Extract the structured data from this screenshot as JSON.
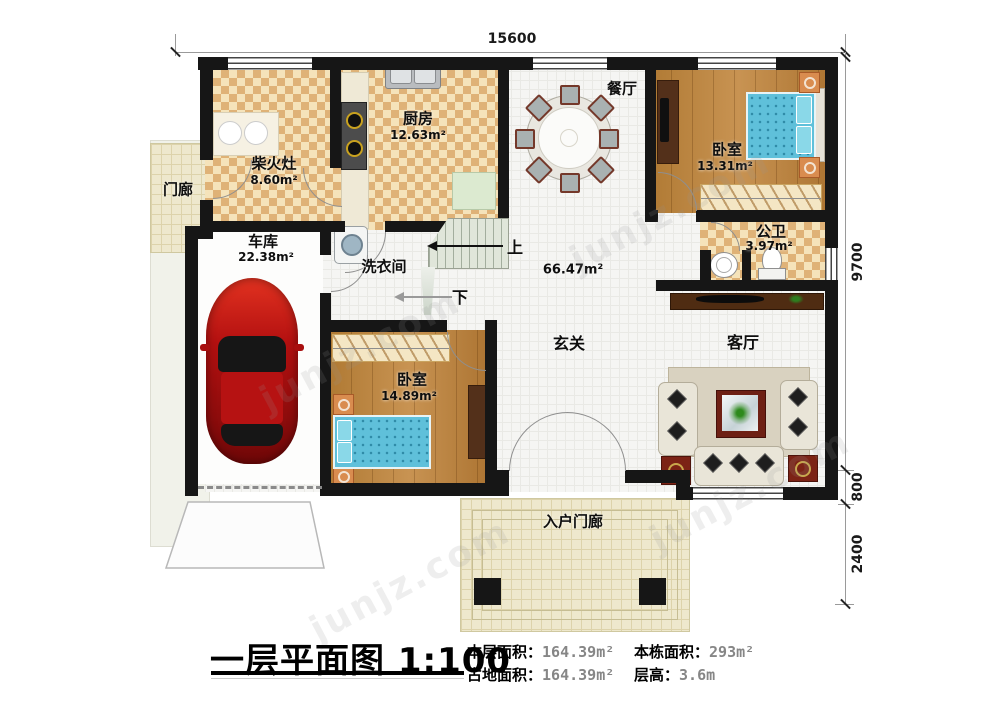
{
  "watermark": {
    "text": "junjz.com"
  },
  "dimensions": {
    "width": "15600",
    "depth": "9700",
    "porch_depth": "800",
    "entry_depth": "2400"
  },
  "rooms": {
    "firewood": {
      "label": "柴火灶",
      "area": "8.60m²"
    },
    "kitchen": {
      "label": "厨房",
      "area": "12.63m²"
    },
    "dining": {
      "label": "餐厅"
    },
    "porch": {
      "label": "门廊"
    },
    "garage": {
      "label": "车库",
      "area": "22.38m²"
    },
    "laundry": {
      "label": "洗衣间"
    },
    "bedroom_a": {
      "label": "卧室",
      "area": "13.31m²"
    },
    "bathroom": {
      "label": "公卫",
      "area": "3.97m²"
    },
    "bedroom_b": {
      "label": "卧室",
      "area": "14.89m²"
    },
    "hall": {
      "label": "玄关",
      "area": "66.47m²"
    },
    "living": {
      "label": "客厅"
    },
    "entry_porch": {
      "label": "入户门廊"
    }
  },
  "stairs": {
    "up": "上",
    "down": "下"
  },
  "title_block": {
    "title": "一层平面图 1:100",
    "stats": [
      {
        "label": "本层面积：",
        "value": "164.39m²"
      },
      {
        "label": "占地面积：",
        "value": "164.39m²"
      },
      {
        "label": "本栋面积：",
        "value": "293m²"
      },
      {
        "label": "层高：",
        "value": "3.6m"
      }
    ]
  }
}
